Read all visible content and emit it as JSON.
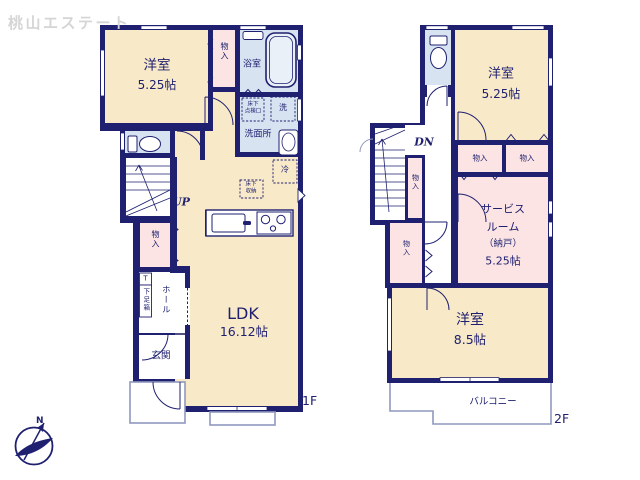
{
  "watermark": "桃山エステート",
  "compass": {
    "north_label": "N"
  },
  "colors": {
    "wall_navy": "#1F2170",
    "room_cream": "#F8E9C8",
    "room_pink": "#FBE4E3",
    "room_blue": "#D8E3F2",
    "outline_gray": "#9098BE",
    "watermark_gray": "#D5D5D5"
  },
  "floor1": {
    "floor_label": "1F",
    "western_room": {
      "name": "洋室",
      "size": "5.25帖"
    },
    "closet_top": "物入",
    "bathroom": "浴室",
    "underfloor_access": {
      "line1": "床下",
      "line2": "点検口"
    },
    "washer": "洗",
    "washroom": "洗面所",
    "fridge": "冷",
    "underfloor_storage": {
      "line1": "床下",
      "line2": "収納"
    },
    "stairs_label": "UP",
    "closet_mid": "物入",
    "shoe_t": "T",
    "shoe_box": "下足箱",
    "hall": "ホール",
    "entrance": "玄関",
    "ldk": {
      "name": "LDK",
      "size": "16.12帖"
    }
  },
  "floor2": {
    "floor_label": "2F",
    "western_room_small": {
      "name": "洋室",
      "size": "5.25帖"
    },
    "stairs_label": "DN",
    "closet_by_stairs": "物入",
    "closet_left": "物入",
    "closet_right": "物入",
    "service_room": {
      "line1": "サービス",
      "line2": "ルーム",
      "line3": "（納戸）",
      "line4": "5.25帖"
    },
    "closet_lower": "物入",
    "western_room_large": {
      "name": "洋室",
      "size": "8.5帖"
    },
    "balcony": "バルコニー"
  }
}
